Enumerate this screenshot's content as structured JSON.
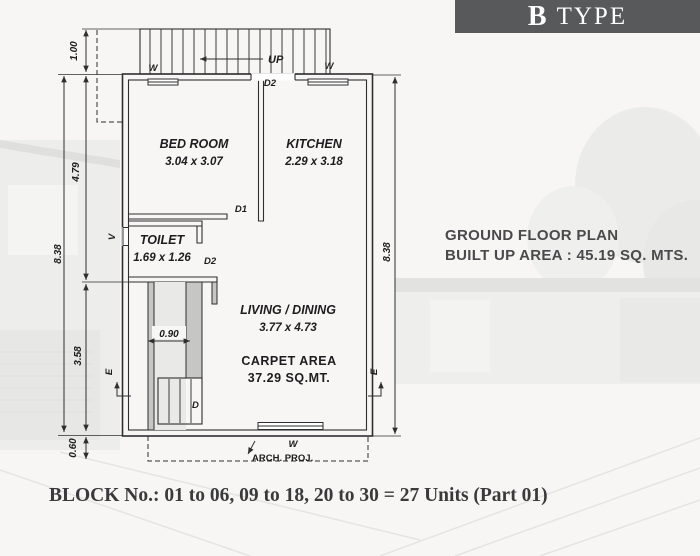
{
  "banner": {
    "letter": "B",
    "word": "TYPE"
  },
  "plan": {
    "rooms": {
      "bedroom": {
        "name": "BED ROOM",
        "size": "3.04 x 3.07"
      },
      "kitchen": {
        "name": "KITCHEN",
        "size": "2.29 x 3.18"
      },
      "toilet": {
        "name": "TOILET",
        "size": "1.69 x 1.26"
      },
      "living": {
        "name": "LIVING / DINING",
        "size": "3.77 x 4.73"
      },
      "carpet_label": "CARPET AREA",
      "carpet_value": "37.29 SQ.MT."
    },
    "labels": {
      "up": "UP",
      "window": "W",
      "door1": "D1",
      "door2": "D2",
      "vent": "V",
      "door": "D",
      "entry": "E",
      "arch_proj": "ARCH. PROJ."
    },
    "dims": {
      "left_total": "8.38",
      "right_total": "8.38",
      "stair_depth": "1.00",
      "upper_left": "4.79",
      "lower_left": "3.58",
      "arch_offset": "0.60",
      "passage_width": "0.90"
    }
  },
  "annotation": {
    "title": "GROUND FLOOR PLAN",
    "area": "BUILT UP AREA : 45.19 SQ. MTS."
  },
  "footer": {
    "caption": "BLOCK No.: 01 to 06, 09 to 18, 20 to 30 = 27 Units (Part 01)"
  },
  "colors": {
    "banner_bg": "#58595b",
    "line": "#2f2f31",
    "annotation_text": "#4a4a4c"
  }
}
